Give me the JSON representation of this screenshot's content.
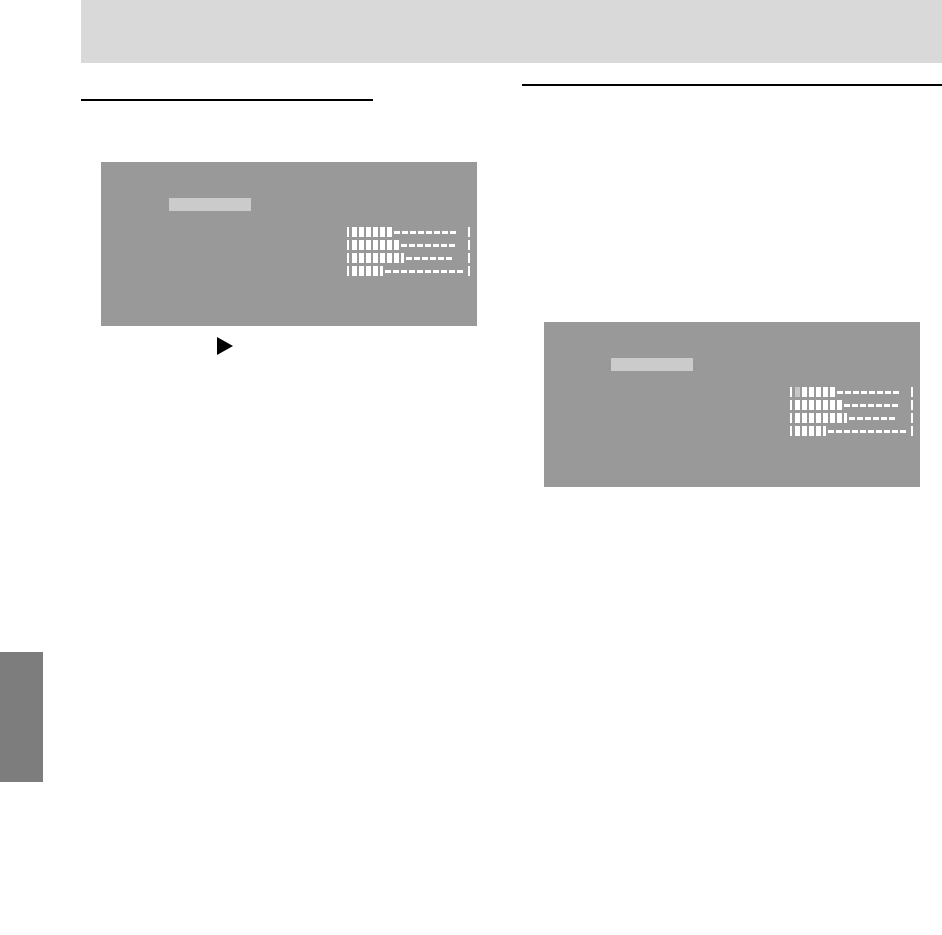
{
  "page": {
    "width": 942,
    "height": 935,
    "background": "#ffffff",
    "header_band_color": "#d9d9d9",
    "rule_color": "#000000",
    "edge_tab_color": "#7d7d7d"
  },
  "figures": {
    "osd_left": {
      "screen_color": "#999999",
      "title_bar_color": "#cbcbcb",
      "bar_color": "#ffffff",
      "dim_bar_color": "#c6c6c6",
      "rows": [
        {
          "filled": 6,
          "half_step": false,
          "dashes": 8,
          "dim_first": false
        },
        {
          "filled": 7,
          "half_step": false,
          "dashes": 7,
          "dim_first": false
        },
        {
          "filled": 7,
          "half_step": true,
          "dashes": 6,
          "dim_first": false
        },
        {
          "filled": 4,
          "half_step": true,
          "dashes": 10,
          "dim_first": false
        }
      ]
    },
    "osd_right": {
      "screen_color": "#999999",
      "title_bar_color": "#cbcbcb",
      "bar_color": "#ffffff",
      "dim_bar_color": "#c6c6c6",
      "rows": [
        {
          "filled": 6,
          "half_step": false,
          "dashes": 8,
          "dim_first": true
        },
        {
          "filled": 7,
          "half_step": false,
          "dashes": 7,
          "dim_first": false
        },
        {
          "filled": 7,
          "half_step": true,
          "dashes": 6,
          "dim_first": false
        },
        {
          "filled": 4,
          "half_step": true,
          "dashes": 10,
          "dim_first": false
        }
      ]
    },
    "step_arrow": {
      "shape": "right-triangle",
      "color": "#000000"
    }
  }
}
